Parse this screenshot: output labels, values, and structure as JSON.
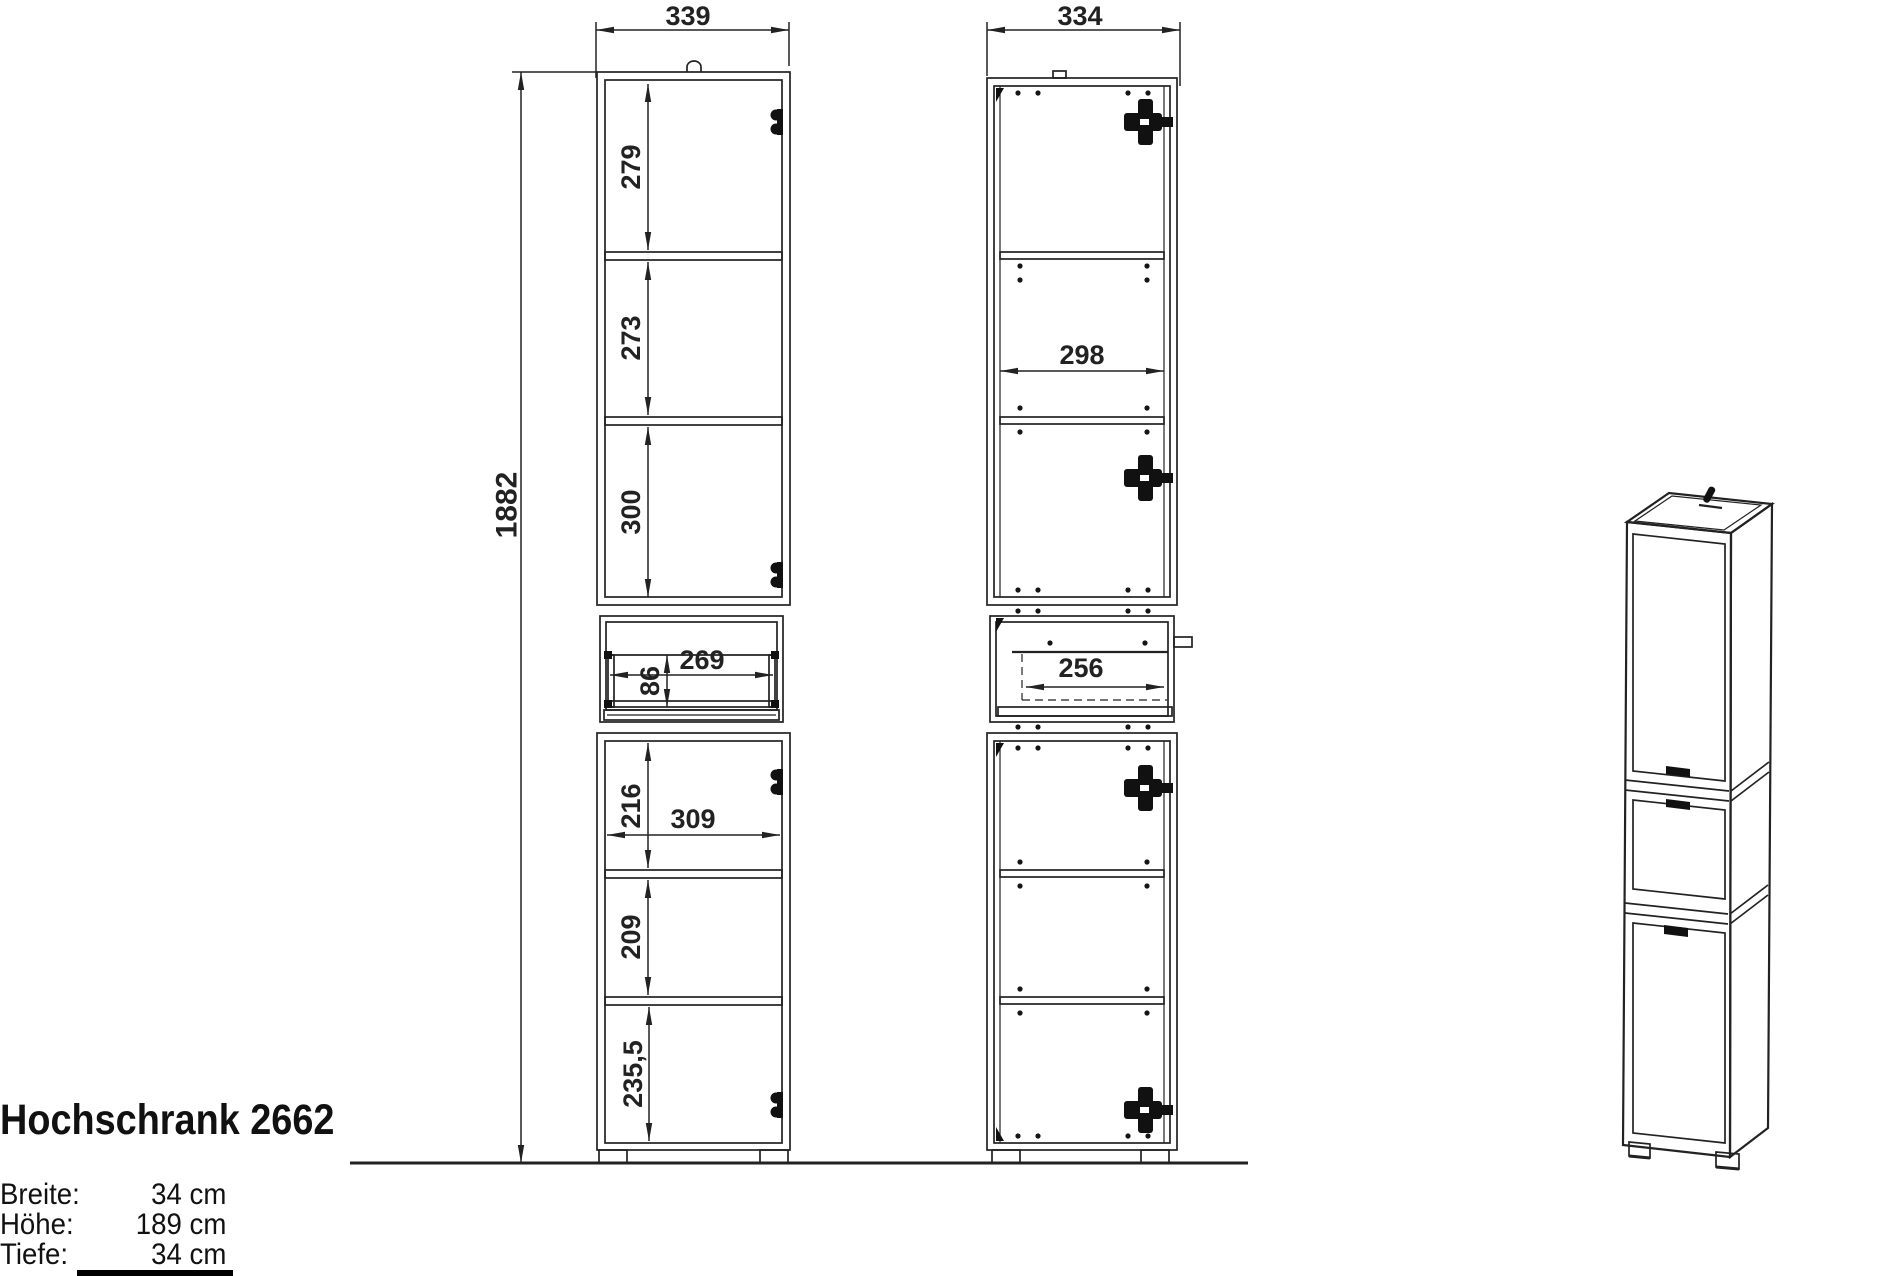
{
  "title": "Hochschrank 2662",
  "specs": [
    {
      "label": "Breite:",
      "value": "34 cm"
    },
    {
      "label": "Höhe:",
      "value": "189 cm"
    },
    {
      "label": "Tiefe:",
      "value": "34 cm"
    }
  ],
  "dims": {
    "front_width": "339",
    "side_width": "334",
    "total_height": "1882",
    "upper_sec1": "279",
    "upper_sec2": "273",
    "upper_sec3": "300",
    "drawer_inner_height": "86",
    "drawer_inner_width": "269",
    "lower_sec1": "216",
    "lower_inner_width": "309",
    "lower_sec2": "209",
    "lower_sec3": "235,5",
    "side_inner_width": "298",
    "side_drawer_width": "256"
  },
  "colors": {
    "line": "#222222",
    "hardware": "#111111",
    "background": "#ffffff"
  }
}
